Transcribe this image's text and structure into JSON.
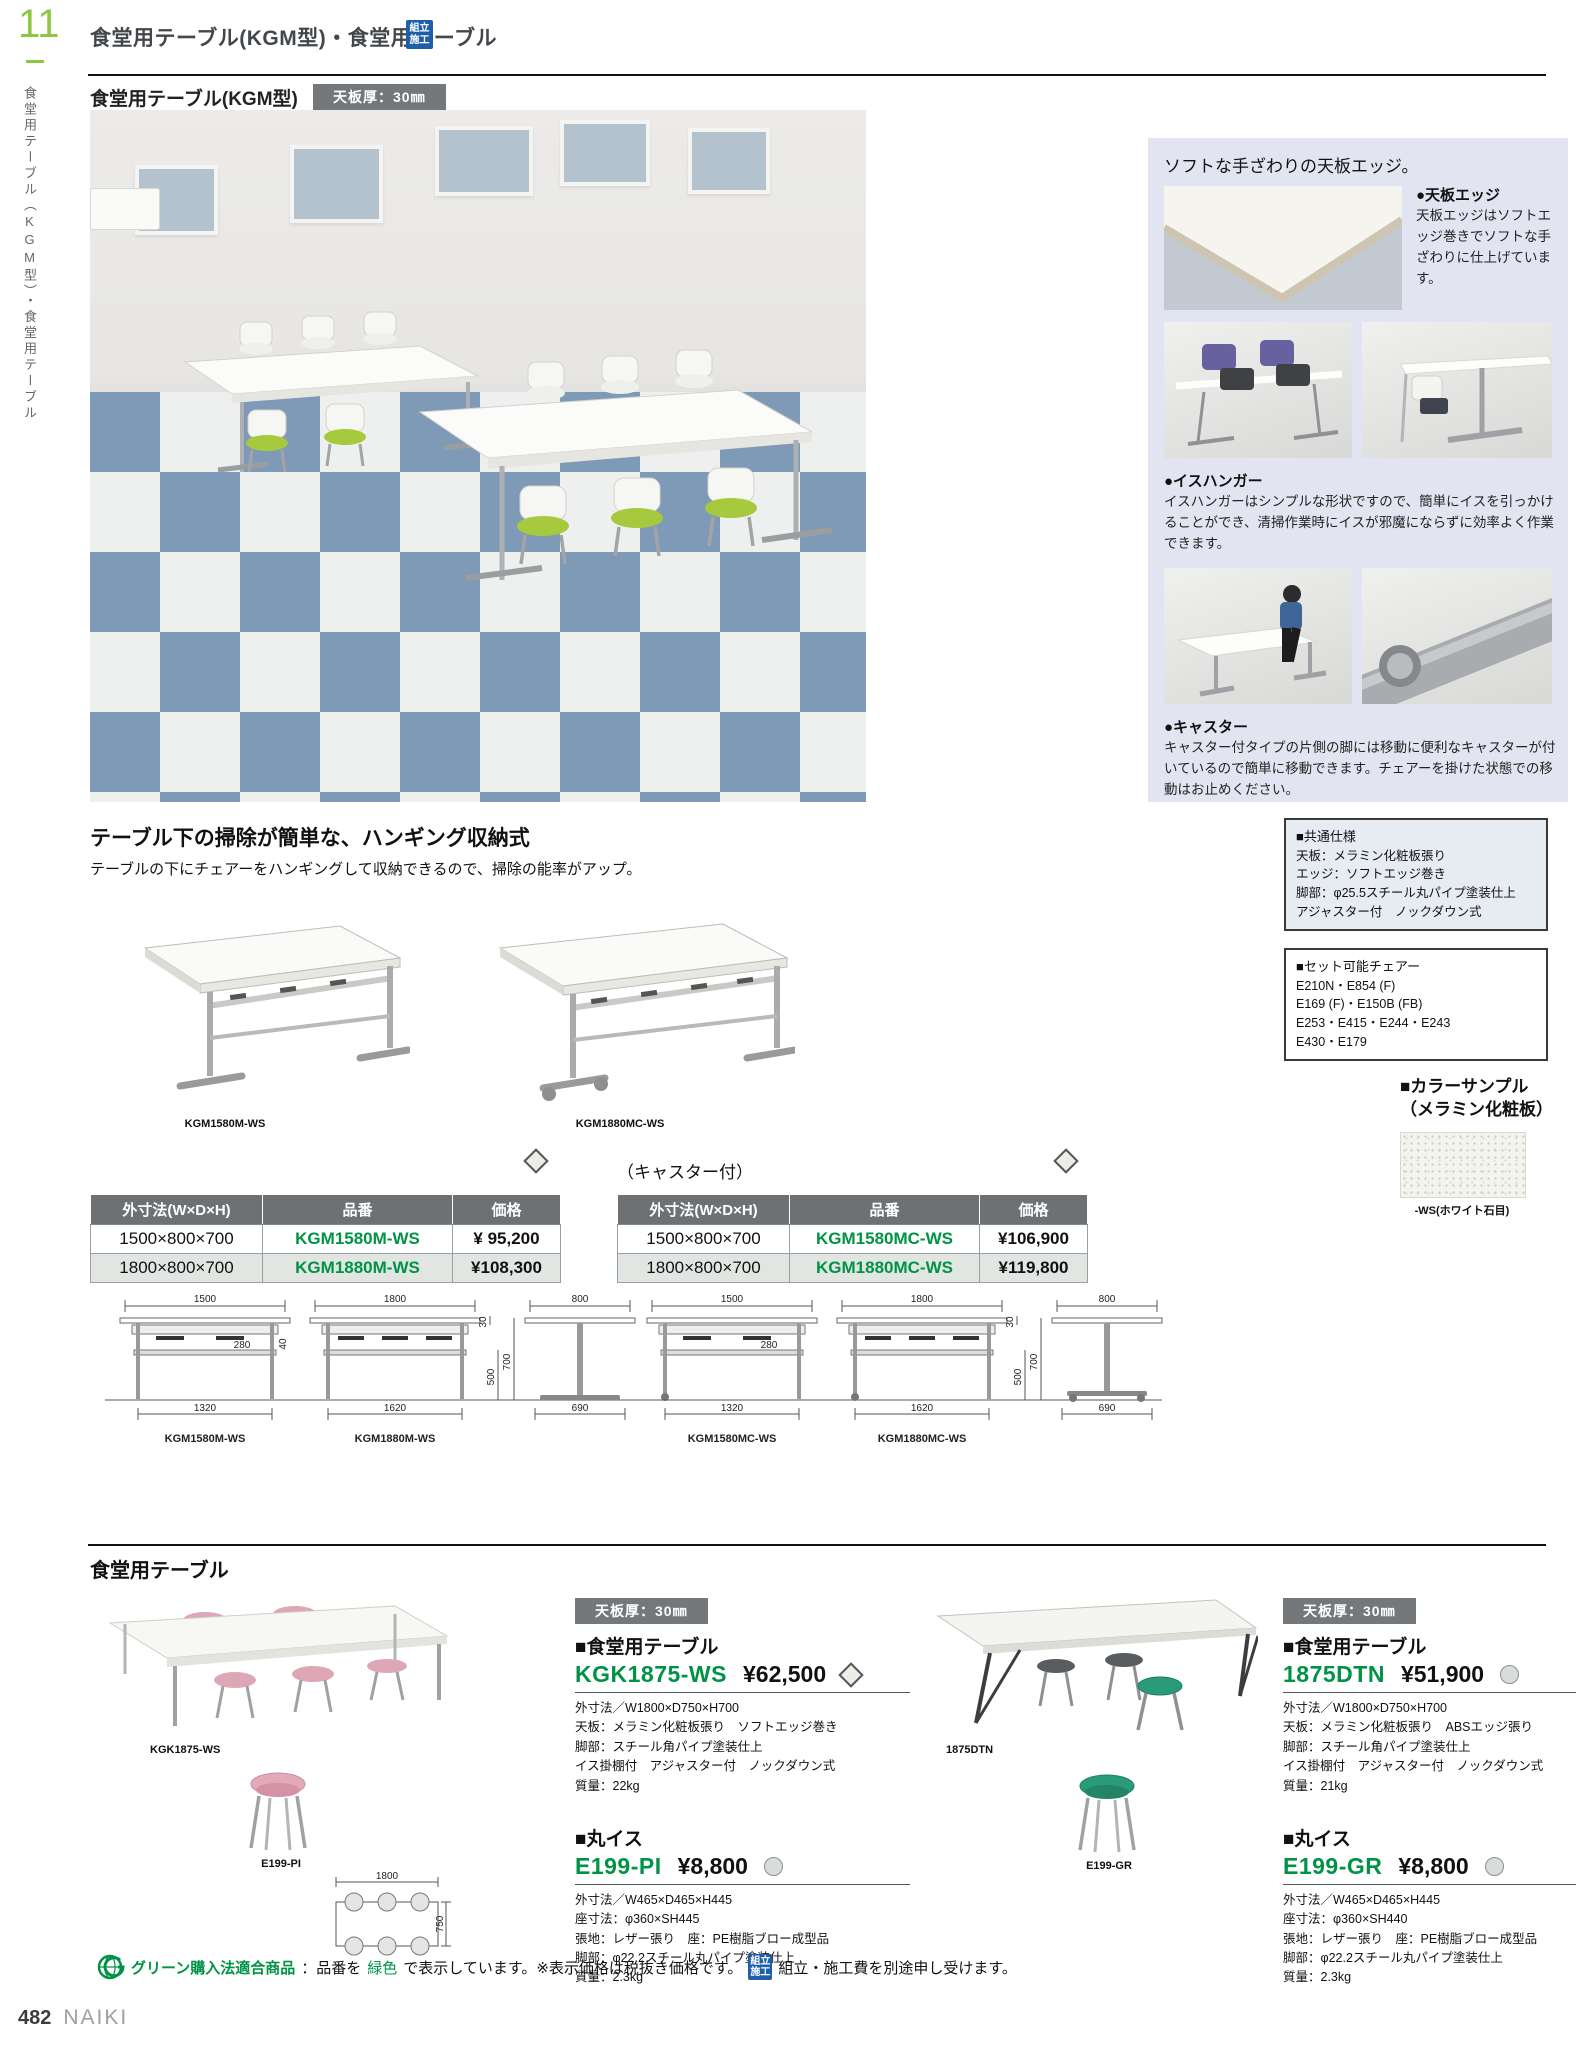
{
  "colors": {
    "accent_green": "#009345",
    "page_number_green": "#8dc63f",
    "assembly_badge_blue": "#1f5fa9",
    "panel_bg": "#e2e5f1",
    "table_header_bg": "#6e7174",
    "row_alt_bg": "#e2e6e2",
    "thickness_badge_bg": "#75787b",
    "floor_tile_blue": "#7f9ab7",
    "chair_green": "#a6c93e"
  },
  "icons": {
    "assembly_badge": "kumitate-sekou blue square badge",
    "green_purchase_mark": "green globe G mark",
    "diamond_mark": "light gray diamond",
    "circle_mark": "light gray circle"
  },
  "page": {
    "number": "11",
    "side_label": "食堂用テーブル（KGM型）・食堂用テーブル"
  },
  "header": {
    "title": "食堂用テーブル(KGM型)・食堂用テーブル",
    "assembly_line1": "組立",
    "assembly_line2": "施工"
  },
  "kgm": {
    "title": "食堂用テーブル(KGM型)",
    "thickness_badge": "天板厚：30㎜",
    "features": {
      "title": "ソフトな手ざわりの天板エッジ。",
      "edge_head": "●天板エッジ",
      "edge_body": "天板エッジはソフトエッジ巻きでソフトな手ざわりに仕上げています。",
      "hanger_head": "●イスハンガー",
      "hanger_body": "イスハンガーはシンプルな形状ですので、簡単にイスを引っかけることができ、清掃作業時にイスが邪魔にならずに効率よく作業できます。",
      "caster_head": "●キャスター",
      "caster_body": "キャスター付タイプの片側の脚には移動に便利なキャスターが付いているので簡単に移動できます。チェアーを掛けた状態での移動はお止めください。"
    },
    "common_spec": {
      "title": "■共通仕様",
      "lines": [
        "天板：メラミン化粧板張り",
        "エッジ：ソフトエッジ巻き",
        "脚部：φ25.5スチール丸パイプ塗装仕上",
        "アジャスター付　ノックダウン式"
      ]
    },
    "chairs_box": {
      "title": "■セット可能チェアー",
      "lines": [
        "E210N・E854 (F)",
        "E169 (F)・E150B (FB)",
        "E253・E415・E244・E243",
        "E430・E179"
      ]
    },
    "color_sample": {
      "title1": "■カラーサンプル",
      "title2": "（メラミン化粧板）",
      "label": "-WS(ホワイト石目)"
    },
    "hanging": {
      "heading": "テーブル下の掃除が簡単な、ハンギング収納式",
      "sub": "テーブルの下にチェアーをハンギングして収納できるので、掃除の能率がアップ。",
      "caption_left": "KGM1580M-WS",
      "caption_right": "KGM1880MC-WS"
    },
    "table_headers": [
      "外寸法(W×D×H)",
      "品番",
      "価格"
    ],
    "table_standard": {
      "rows": [
        [
          "1500×800×700",
          "KGM1580M-WS",
          "¥ 95,200"
        ],
        [
          "1800×800×700",
          "KGM1880M-WS",
          "¥108,300"
        ]
      ]
    },
    "table_caster": {
      "label": "（キャスター付）",
      "rows": [
        [
          "1500×800×700",
          "KGM1580MC-WS",
          "¥106,900"
        ],
        [
          "1800×800×700",
          "KGM1880MC-WS",
          "¥119,800"
        ]
      ]
    },
    "dims": {
      "w1500": "1500",
      "w1800": "1800",
      "t30": "30",
      "d800": "800",
      "hook280": "280",
      "hook40": "40",
      "h500": "500",
      "h700": "700",
      "b1320": "1320",
      "b1620": "1620",
      "f690": "690"
    },
    "dim_captions": [
      "KGM1580M-WS",
      "KGM1880M-WS",
      "KGM1580MC-WS",
      "KGM1880MC-WS"
    ]
  },
  "dining": {
    "title": "食堂用テーブル",
    "topview": {
      "w": "1800",
      "d": "750"
    },
    "products": [
      {
        "photo_caption": "KGK1875-WS",
        "thickness_badge": "天板厚：30㎜",
        "table_head": "■食堂用テーブル",
        "table_code": "KGK1875-WS",
        "table_price": "¥62,500",
        "table_specs": [
          "外寸法／W1800×D750×H700",
          "天板：メラミン化粧板張り　ソフトエッジ巻き",
          "脚部：スチール角パイプ塗装仕上",
          "イス掛棚付　アジャスター付　ノックダウン式",
          "質量：22kg"
        ],
        "stool_head": "■丸イス",
        "stool_code": "E199-PI",
        "stool_price": "¥8,800",
        "stool_caption": "E199-PI",
        "stool_specs": [
          "外寸法／W465×D465×H445",
          "座寸法：φ360×SH445",
          "張地：レザー張り　座：PE樹脂ブロー成型品",
          "脚部：φ22.2スチール丸パイプ塗装仕上",
          "質量：2.3kg"
        ]
      },
      {
        "photo_caption": "1875DTN",
        "thickness_badge": "天板厚：30㎜",
        "table_head": "■食堂用テーブル",
        "table_code": "1875DTN",
        "table_price": "¥51,900",
        "table_specs": [
          "外寸法／W1800×D750×H700",
          "天板：メラミン化粧板張り　ABSエッジ張り",
          "脚部：スチール角パイプ塗装仕上",
          "イス掛棚付　アジャスター付　ノックダウン式",
          "質量：21kg"
        ],
        "stool_head": "■丸イス",
        "stool_code": "E199-GR",
        "stool_price": "¥8,800",
        "stool_caption": "E199-GR",
        "stool_specs": [
          "外寸法／W465×D465×H445",
          "座寸法：φ360×SH440",
          "張地：レザー張り　座：PE樹脂ブロー成型品",
          "脚部：φ22.2スチール丸パイプ塗装仕上",
          "質量：2.3kg"
        ]
      }
    ]
  },
  "footnote": {
    "green_label": "グリーン購入法適合商品",
    "seg1": "：品番を",
    "green_word": "緑色",
    "seg2": "で表示しています。※表示価格は税抜き価格です。",
    "badge_line1": "組立",
    "badge_line2": "施工",
    "seg3": "組立・施工費を別途申し受けます。"
  },
  "footer": {
    "page": "482",
    "brand": "NAIKI"
  }
}
